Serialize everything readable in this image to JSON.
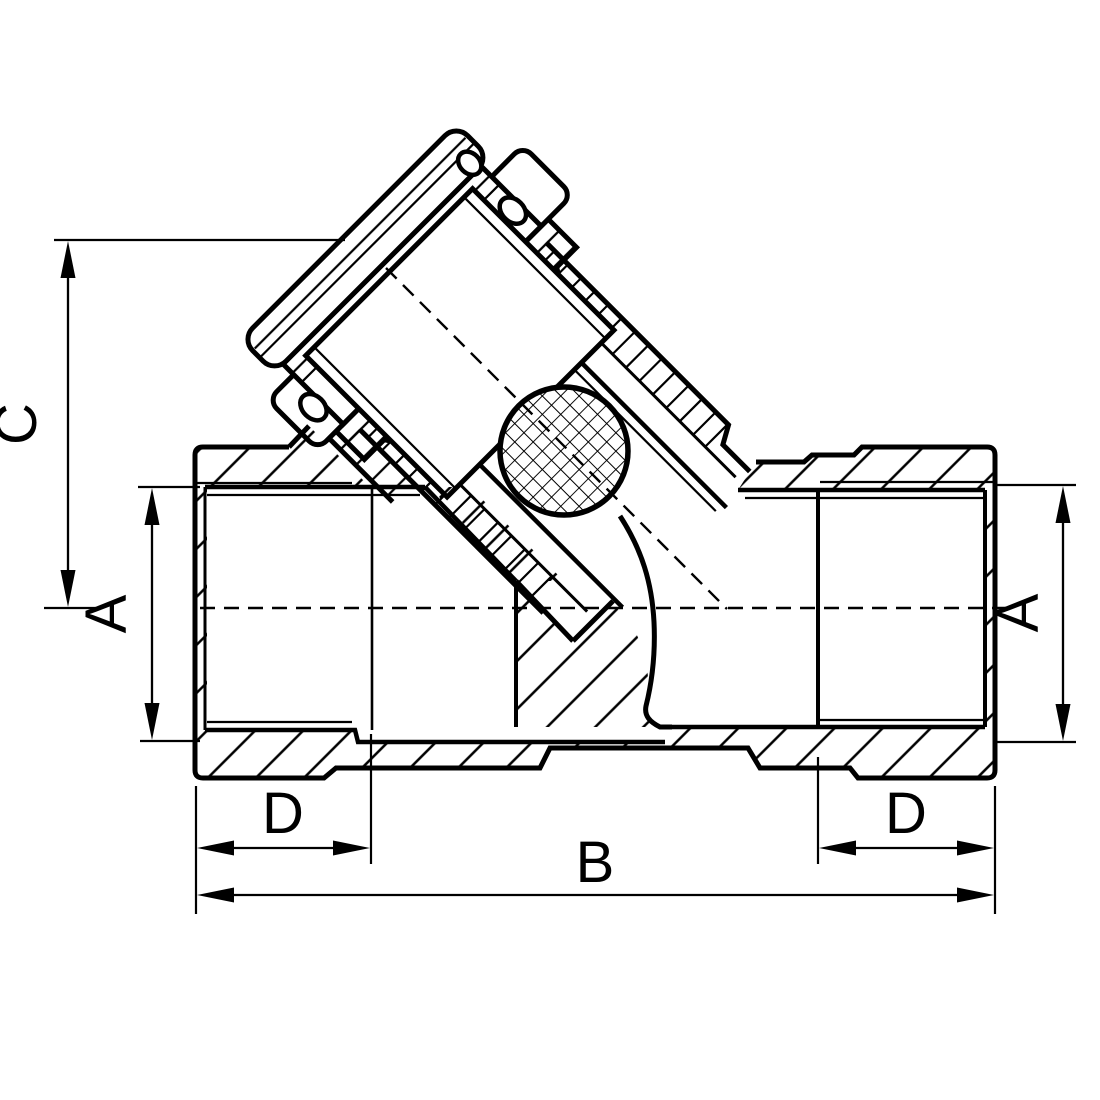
{
  "drawing": {
    "title": "Y-strainer valve sectional technical drawing",
    "background": "#ffffff",
    "line_color": "#000000",
    "labels": {
      "c": "C",
      "a_left": "A",
      "a_right": "A",
      "d_left": "D",
      "d_right": "D",
      "b": "B"
    },
    "features": [
      "valve-body",
      "left-threaded-port",
      "right-threaded-port",
      "angled-strainer-cap-assembly",
      "filter-mesh-screen",
      "cap-bolt-holes",
      "center-dashed-axis-lines"
    ]
  }
}
